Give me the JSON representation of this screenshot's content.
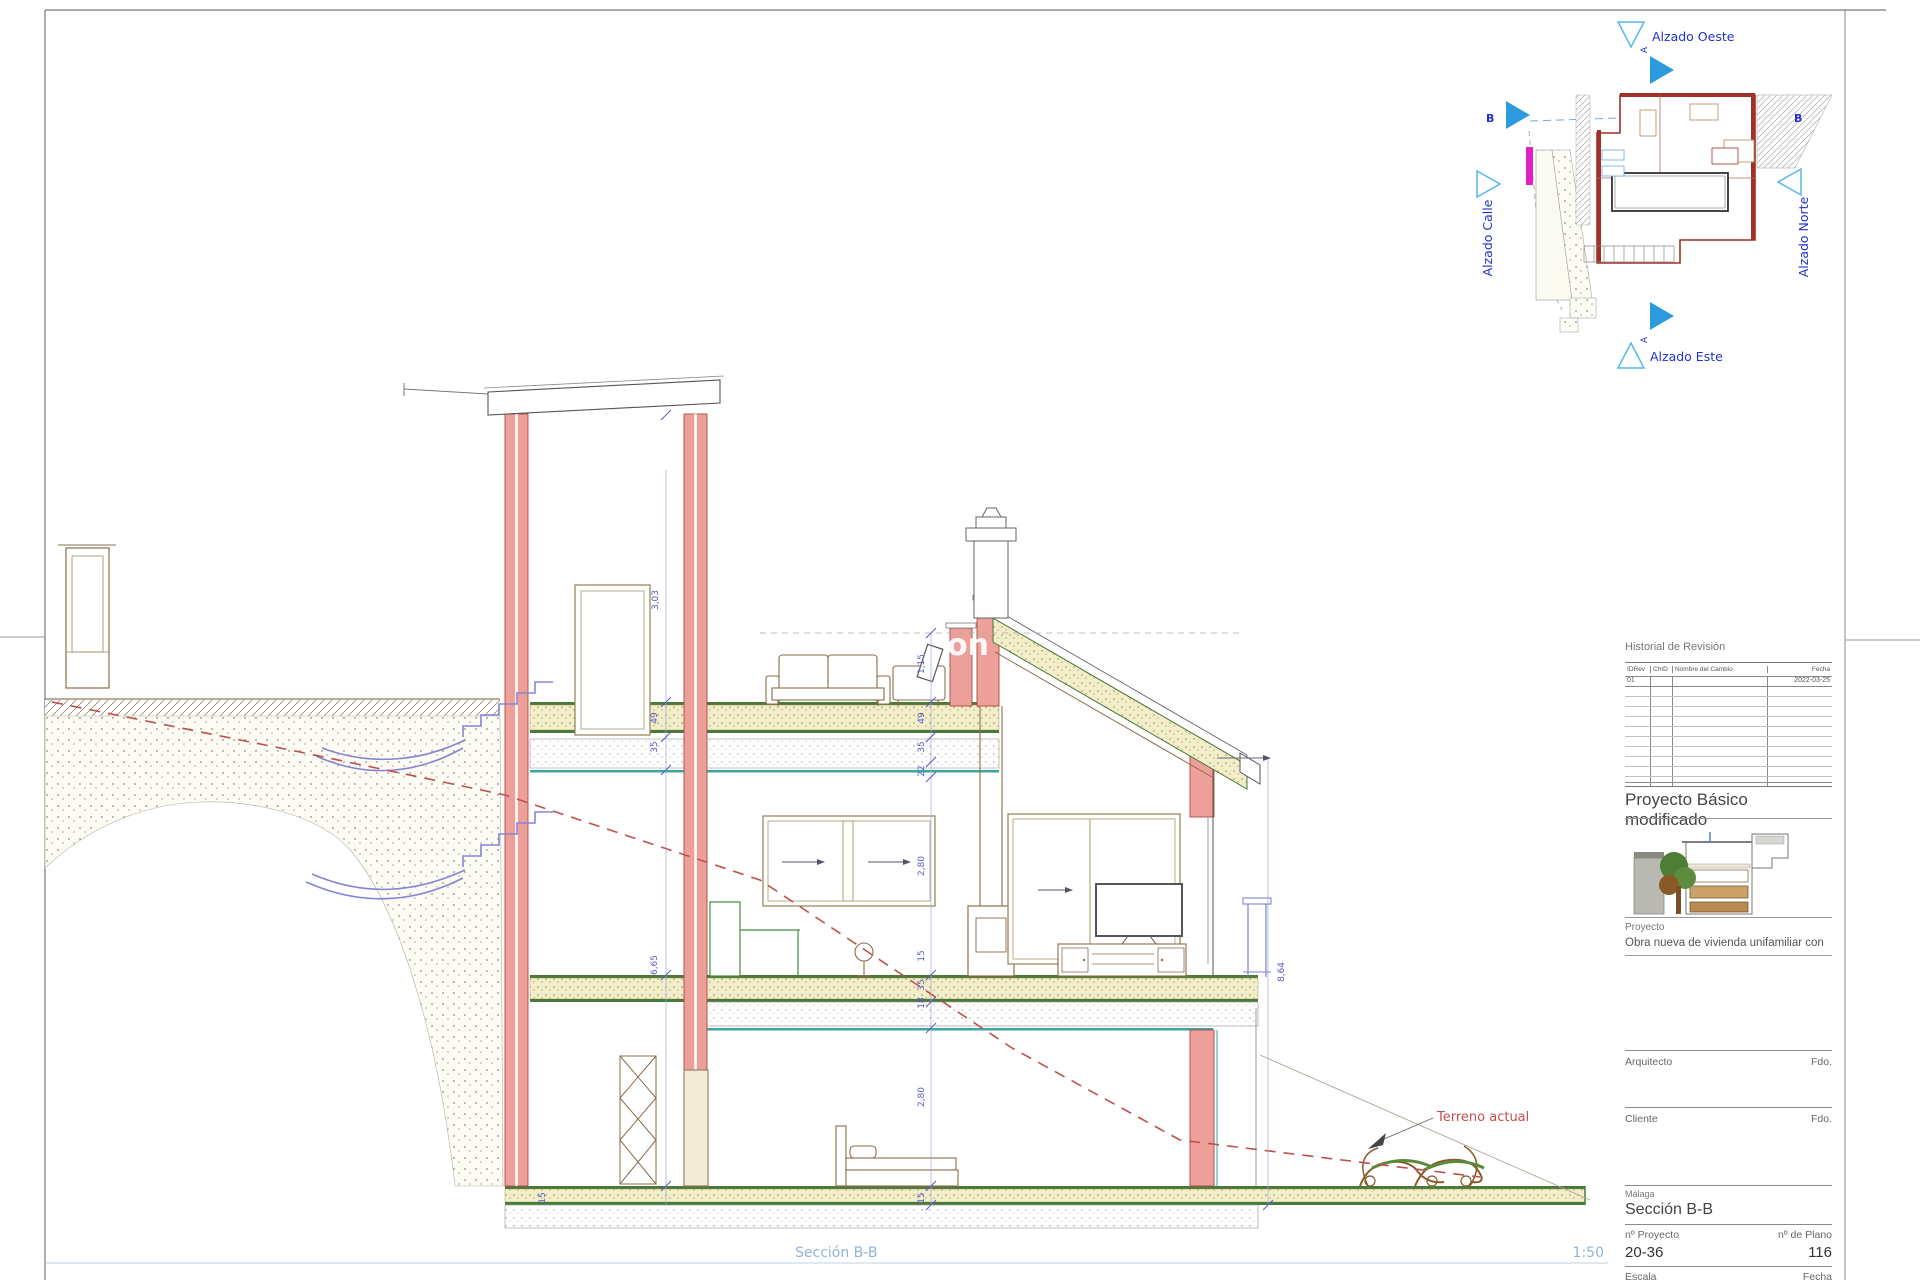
{
  "sheet": {
    "drawing_caption": "Sección B-B",
    "scale_note": "1:50",
    "watermark": "on"
  },
  "plan_key": {
    "label_top": "Alzado Oeste",
    "label_bottom": "Alzado Este",
    "label_left": "Alzado Calle",
    "label_right": "Alzado Norte",
    "section_letter_left": "B",
    "section_letter_right": "B",
    "arrow_letter_top": "A",
    "arrow_letter_bottom": "A"
  },
  "section": {
    "terrain_label": "Terreno actual",
    "dims_left": [
      "3,03",
      "49",
      "35",
      "6,65"
    ],
    "dims_center": [
      "1,15",
      "49",
      "35",
      "22",
      "2,80",
      "15",
      "35",
      "18",
      "2,80",
      "15"
    ],
    "dim_right": "8,64",
    "dim_bottom": "15"
  },
  "title_block": {
    "revision_title": "Historial de Revisión",
    "revision_headers": [
      "IDRev",
      "ChID",
      "Nombre del Cambio",
      "Fecha"
    ],
    "revision_row": {
      "id": "01",
      "date": "2022-03-25"
    },
    "project_type": "Proyecto Básico modificado",
    "project_label": "Proyecto",
    "project_name": "Obra nueva de vivienda unifamiliar con",
    "architect_label": "Arquitecto",
    "architect_sign": "Fdo.",
    "client_label": "Cliente",
    "client_sign": "Fdo.",
    "city": "Málaga",
    "sheet_title": "Sección B-B",
    "project_no_label": "nº Proyecto",
    "project_no": "20-36",
    "plan_no_label": "nº de Plano",
    "plan_no": "116",
    "scale_label": "Escala",
    "date_label": "Fecha"
  }
}
